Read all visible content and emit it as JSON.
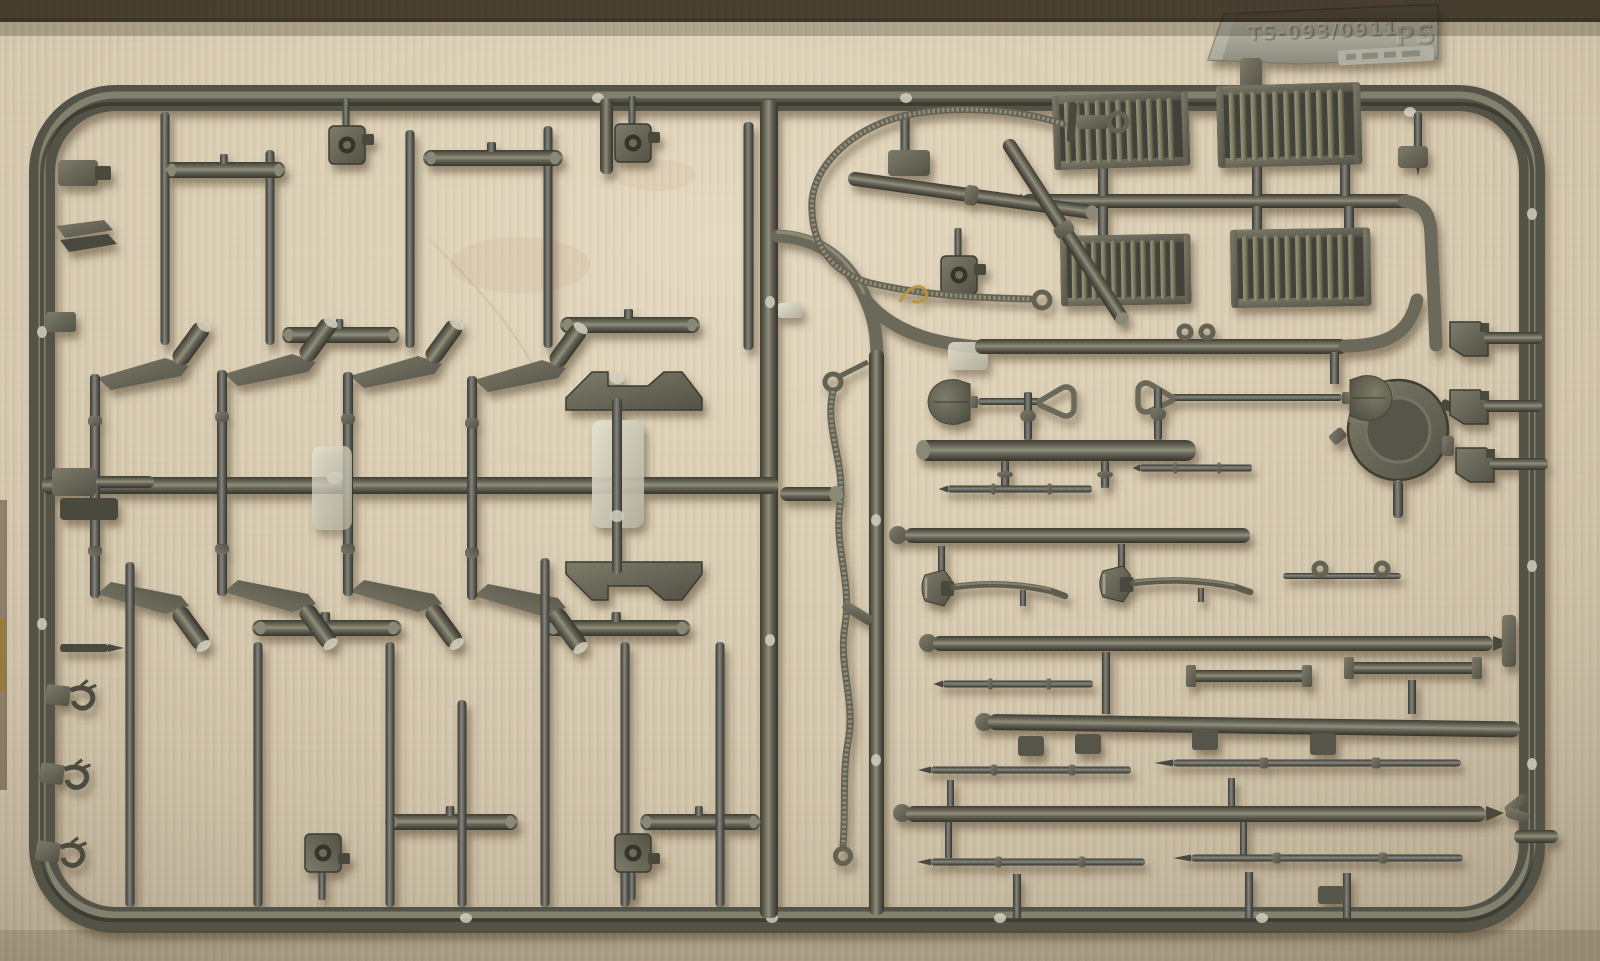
{
  "scene": {
    "description": "Photograph of a dark olive-grey injection-molded plastic model kit sprue (parts frame) lying on ribbed tan fabric",
    "background": "ribbed tan fabric with warm lighting, dark shadow band along top edge",
    "object": "rectangular sprue frame with rounded corners holding suspension arms, rods, pioneer tools and grilles"
  },
  "sprue_tag": {
    "mold_code": "TS-093/0911",
    "material_code": "PS",
    "stamp_note": "small illegible embossed date stamp below tag"
  },
  "palette": {
    "fabric_light": "#d9ceb6",
    "fabric_mid": "#cfc3ab",
    "fabric_dark": "#b5a78d",
    "plastic_base": "#67665a",
    "plastic_dark": "#3e3d33",
    "plastic_highlight": "#a6a390",
    "tag_metal": "#aeada1",
    "gate_shine": "#d9d6c6",
    "stray_thread_gold": "#b8933b"
  },
  "parts_inventory": {
    "louvered_grilles": 4,
    "shovels": 2,
    "axes": 2,
    "braided_tow_cables": 2,
    "crossed_cylinder_rods": 2,
    "round_hatch": 1,
    "suspension_swing_arms": 8,
    "bell_crank_mount": 1,
    "link_bars": 9,
    "vertical_rods": 12,
    "horizontal_thin_rods": 9,
    "square_clamps": 5,
    "towing_hooks": 3,
    "right_edge_brackets": 3
  }
}
